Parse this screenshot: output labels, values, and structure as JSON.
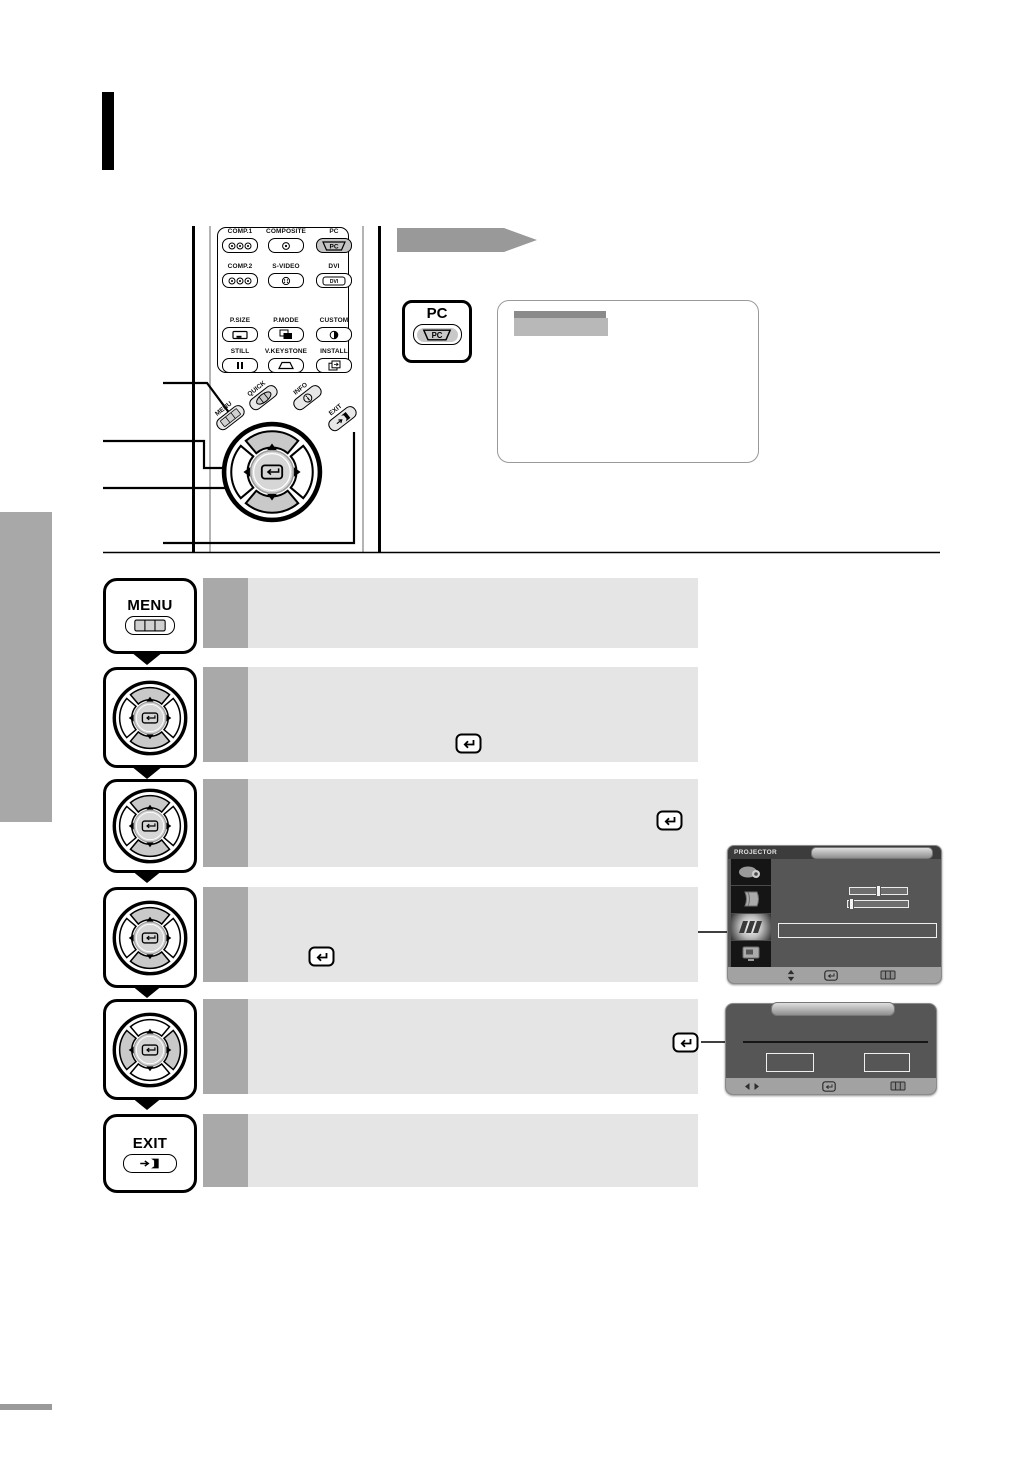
{
  "colors": {
    "step_box": "#e5e5e5",
    "step_strip": "#a9a9a9",
    "sidebar_gray": "#a8a8a8",
    "banner_arrow": "#999999",
    "osd_body": "#565656",
    "osd_titlebar": "#3c3c3c",
    "osd_icon_column": "#151515",
    "osd_bottom_bar": "#a2a2a2",
    "osd_pill": "#b5b5b5",
    "highlighted_button": "#c4c4c4"
  },
  "glyphs": {
    "pc": "PC",
    "dvi": "DVI"
  },
  "remote": {
    "source_buttons": [
      {
        "label": "COMP.1",
        "icon": "three-rca-icon"
      },
      {
        "label": "COMPOSITE",
        "icon": "single-rca-icon"
      },
      {
        "label": "PC",
        "icon": "pc-port-icon",
        "highlighted": true
      },
      {
        "label": "COMP.2",
        "icon": "three-rca-icon"
      },
      {
        "label": "S-VIDEO",
        "icon": "svideo-port-icon"
      },
      {
        "label": "DVI",
        "icon": "dvi-port-icon"
      }
    ],
    "function_buttons": [
      {
        "label": "P.SIZE",
        "icon": "picture-size-icon"
      },
      {
        "label": "P.MODE",
        "icon": "picture-mode-icon"
      },
      {
        "label": "CUSTOM",
        "icon": "contrast-icon"
      },
      {
        "label": "STILL",
        "icon": "pause-icon"
      },
      {
        "label": "V.KEYSTONE",
        "icon": "keystone-icon"
      },
      {
        "label": "INSTALL",
        "icon": "install-icon"
      }
    ],
    "nav_buttons": [
      {
        "label": "MENU",
        "icon": "menu-bars-icon"
      },
      {
        "label": "QUICK",
        "icon": "quick-icon"
      },
      {
        "label": "INFO",
        "icon": "info-icon"
      },
      {
        "label": "EXIT",
        "icon": "exit-door-icon"
      }
    ]
  },
  "pc_callout": {
    "label": "PC"
  },
  "steps": [
    {
      "button": "MENU",
      "icon": "menu-button"
    },
    {
      "button": "",
      "icon": "dpad-updown",
      "enter_icon": true
    },
    {
      "button": "",
      "icon": "dpad-updown",
      "enter_icon": true
    },
    {
      "button": "",
      "icon": "dpad-updown",
      "enter_icon": true
    },
    {
      "button": "",
      "icon": "dpad-leftright",
      "enter_icon": true
    },
    {
      "button": "EXIT",
      "icon": "exit-button"
    }
  ],
  "osd_menu_screen": {
    "title": "PROJECTOR",
    "sidebar_icons": [
      "projector-icon",
      "page-icon",
      "setup-icon",
      "display-icon"
    ],
    "selected_icon_index": 2,
    "sliders": [
      {
        "knob_position_pct": 45
      },
      {
        "knob_position_pct": 2
      }
    ],
    "bottom_icons": [
      "move-updown-icon",
      "enter-icon",
      "menu-bars-icon"
    ]
  },
  "osd_confirm_screen": {
    "option_boxes": 2,
    "bottom_icons": [
      "move-leftright-icon",
      "enter-icon",
      "menu-bars-icon"
    ]
  }
}
